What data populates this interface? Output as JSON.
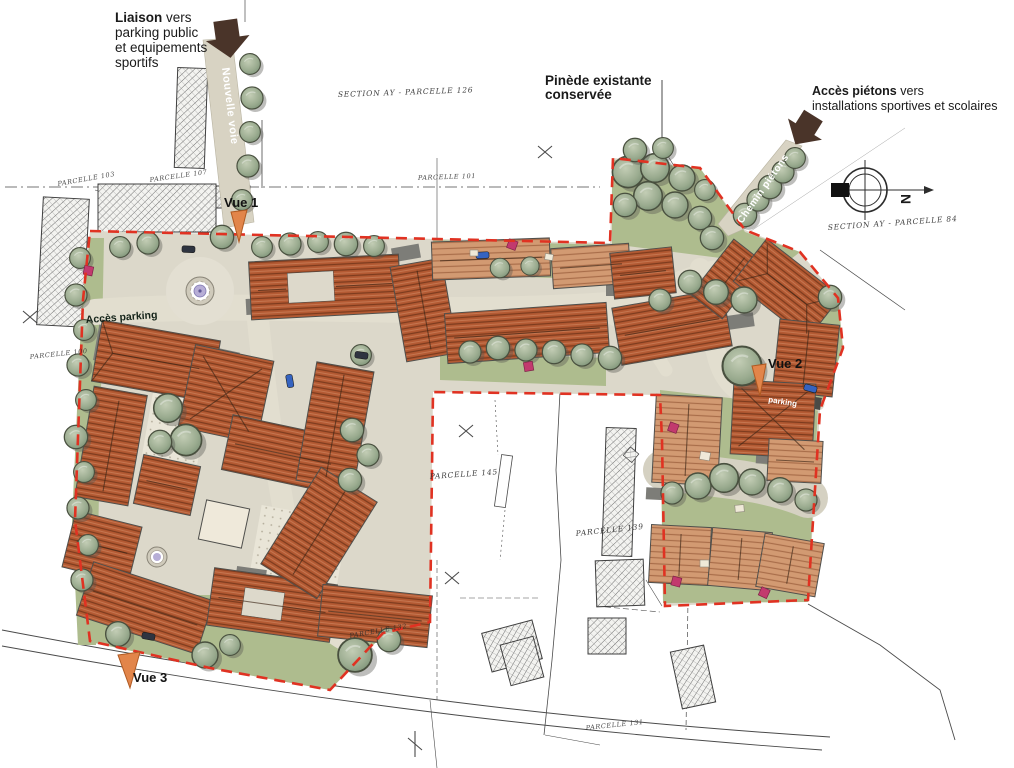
{
  "annotations": {
    "liaison": {
      "line1_bold": "Liaison",
      "line1_rest": " vers",
      "line2": "parking public",
      "line3": "et equipements",
      "line4": "sportifs"
    },
    "pinede": {
      "line1": "Pinède existante",
      "line2": "conservée"
    },
    "acces_pietons": {
      "line1_bold": "Accès piétons",
      "line1_rest": " vers",
      "line2": "installations sportives et scolaires"
    }
  },
  "road_labels": {
    "nouvelle_voie": "Nouvelle voie",
    "chemin_pietons": "Chemin piétons",
    "acces_parking": "Accès parking",
    "parking": "parking"
  },
  "view_markers": {
    "vue1": "Vue 1",
    "vue2": "Vue 2",
    "vue3": "Vue 3"
  },
  "survey_labels": {
    "section_126": "SECTION AY - PARCELLE 126",
    "section_84": "SECTION AY - PARCELLE 84"
  },
  "parcels": [
    "PARCELLE 103",
    "PARCELLE 107",
    "PARCELLE 101",
    "PARCELLE 100",
    "PARCELLE 145",
    "PARCELLE 139",
    "PARCELLE 132",
    "PARCELLE 131"
  ],
  "compass": {
    "north": "N"
  },
  "colors": {
    "boundary_red": "#e03222",
    "roof_terracotta": "#b45a33",
    "roof_salmon": "#d29a72",
    "tree_green": "#9fae92",
    "lawn_green": "#aebc8e",
    "road_beige": "#dcd8ca",
    "arrow_brown": "#4a3429",
    "fountain_violet": "#b7aed6",
    "accent_pink": "#c23a6e"
  }
}
